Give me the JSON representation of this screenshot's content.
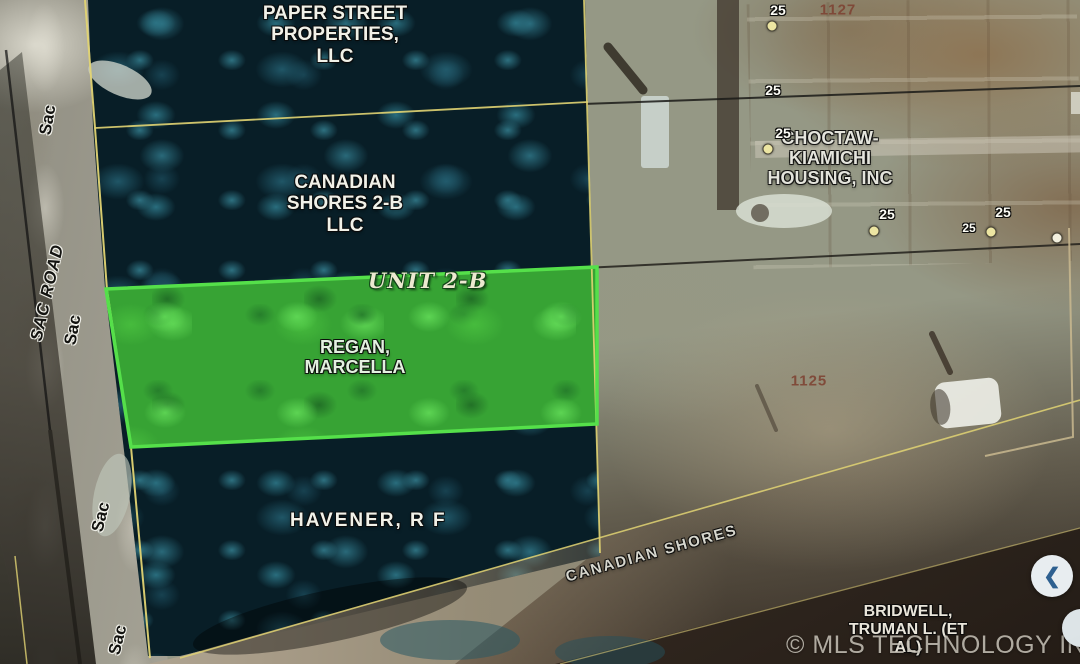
{
  "app": {
    "watermark": "© MLS TECHNOLOGY INC 2025",
    "nav_back_chevron": "❮"
  },
  "map": {
    "parcel_labels": {
      "paper_street": "PAPER STREET\nPROPERTIES,\nLLC",
      "canadian_shores_2b": "CANADIAN\nSHORES 2-B\nLLC",
      "unit_2b": "UNIT 2-B",
      "regan": "REGAN,\nMARCELLA",
      "havener": "HAVENER, R F",
      "choctaw": "CHOCTAW-\nKIAMICHI\nHOUSING, INC",
      "bridwell": "BRIDWELL,\nTRUMAN L. (ET\nAL)"
    },
    "road_labels": {
      "canadian_shores": "CANADIAN SHORES",
      "sac_road": "SAC ROAD",
      "sac_repeats": [
        {
          "text": "Sac",
          "x": 48,
          "y": 120,
          "rot": -80
        },
        {
          "text": "Sac",
          "x": 73,
          "y": 330,
          "rot": -80
        },
        {
          "text": "Sac",
          "x": 101,
          "y": 517,
          "rot": -76
        },
        {
          "text": "Sac",
          "x": 118,
          "y": 640,
          "rot": -76
        }
      ]
    },
    "survey_markers": [
      {
        "label": "25",
        "x": 778,
        "y": 10,
        "dot": true,
        "dot_x": 772,
        "dot_y": 26,
        "small": false
      },
      {
        "label": "25",
        "x": 773,
        "y": 90,
        "dot": false,
        "small": false
      },
      {
        "label": "25",
        "x": 783,
        "y": 133,
        "dot": true,
        "dot_x": 768,
        "dot_y": 149,
        "small": false
      },
      {
        "label": "25",
        "x": 887,
        "y": 214,
        "dot": true,
        "dot_x": 874,
        "dot_y": 231,
        "small": false
      },
      {
        "label": "25",
        "x": 1003,
        "y": 212,
        "dot": false,
        "small": false
      },
      {
        "label": "25",
        "x": 969,
        "y": 228,
        "dot": true,
        "dot_x": 991,
        "dot_y": 232,
        "small": true
      }
    ],
    "lone_dots": [
      {
        "x": 1057,
        "y": 238
      }
    ],
    "ref_numbers": [
      {
        "text": "1127",
        "x": 838,
        "y": 10
      },
      {
        "text": "1125",
        "x": 809,
        "y": 381
      }
    ],
    "colors": {
      "parcel_line_yellow": "#e2d473",
      "highlight_green": "#55e04a",
      "marker_dot": "#ece5a2",
      "ref_number": "#7e4434"
    }
  }
}
